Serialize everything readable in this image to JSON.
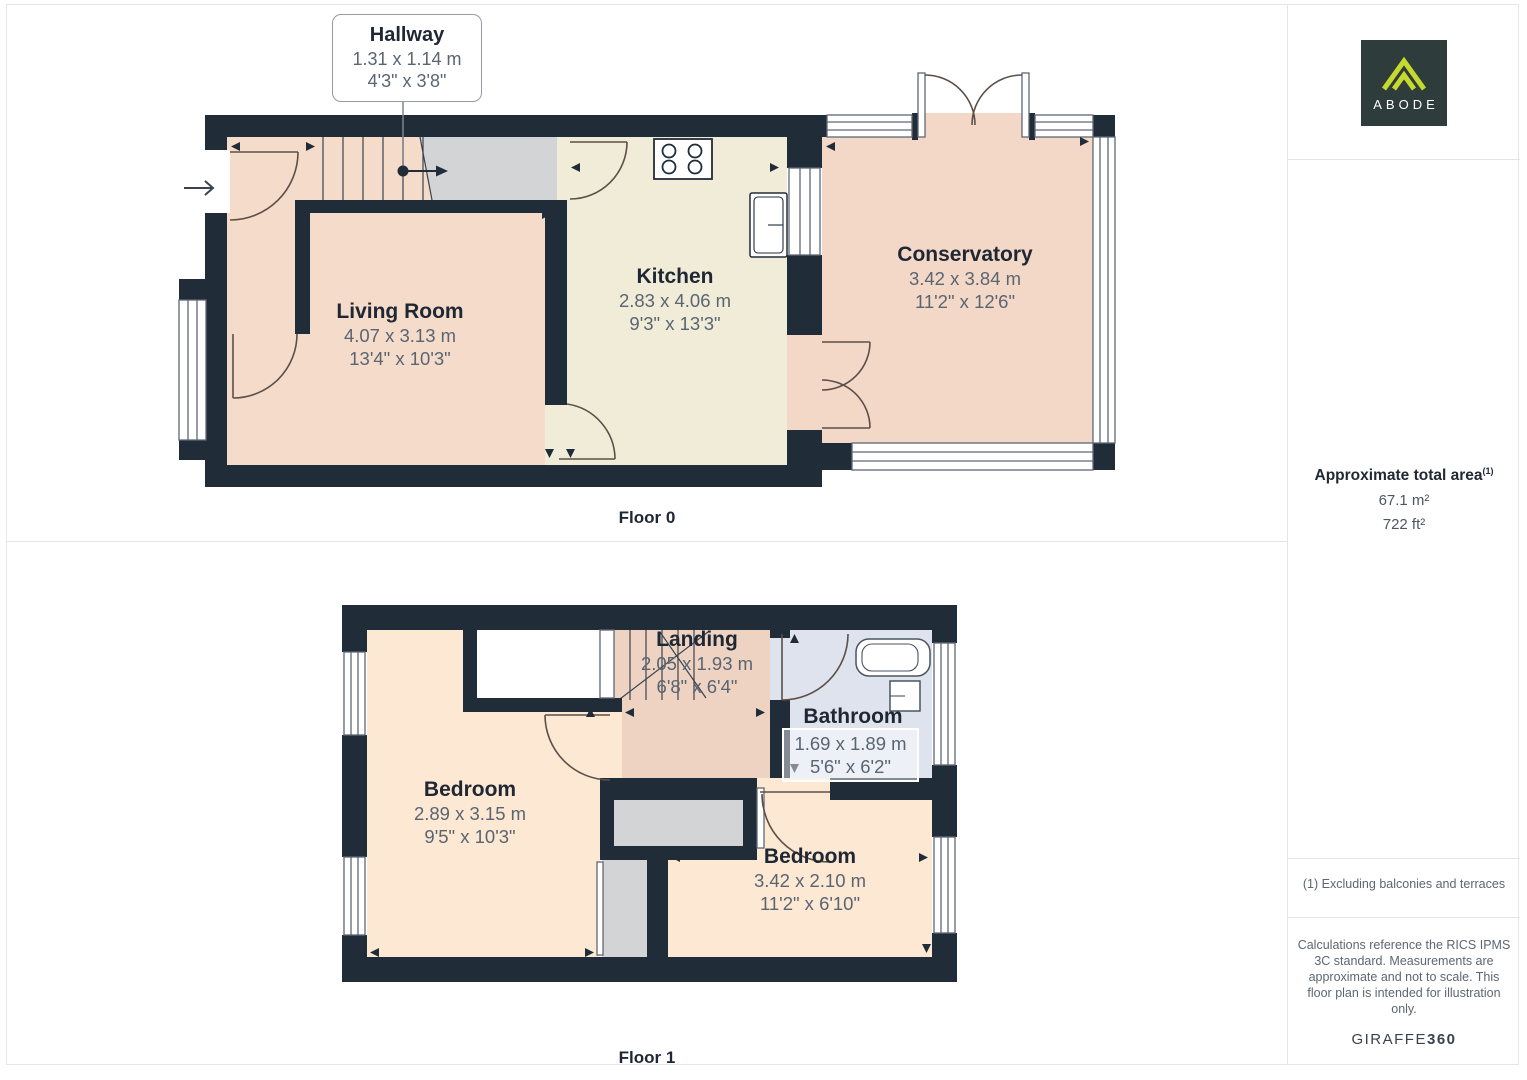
{
  "floors": [
    {
      "label": "Floor 0",
      "rooms": {
        "hallway": {
          "name": "Hallway",
          "metric": "1.31 x 1.14 m",
          "imperial": "4'3\" x 3'8\""
        },
        "living_room": {
          "name": "Living Room",
          "metric": "4.07 x 3.13 m",
          "imperial": "13'4\" x 10'3\""
        },
        "kitchen": {
          "name": "Kitchen",
          "metric": "2.83 x 4.06 m",
          "imperial": "9'3\" x 13'3\""
        },
        "conservatory": {
          "name": "Conservatory",
          "metric": "3.42 x 3.84 m",
          "imperial": "11'2\" x 12'6\""
        }
      }
    },
    {
      "label": "Floor 1",
      "rooms": {
        "landing": {
          "name": "Landing",
          "metric": "2.05 x 1.93 m",
          "imperial": "6'8\" x 6'4\""
        },
        "bathroom": {
          "name": "Bathroom",
          "metric": "1.69 x 1.89 m",
          "imperial": "5'6\" x 6'2\""
        },
        "bedroom_left": {
          "name": "Bedroom",
          "metric": "2.89 x 3.15 m",
          "imperial": "9'5\" x 10'3\""
        },
        "bedroom_right": {
          "name": "Bedroom",
          "metric": "3.42 x 2.10 m",
          "imperial": "11'2\" x 6'10\""
        }
      }
    }
  ],
  "sidebar": {
    "logo": {
      "text": "ABODE",
      "bg_color": "#2e3c3b",
      "accent_color": "#c6d92f"
    },
    "total_area": {
      "label": "Approximate total area",
      "footnote_marker": "(1)",
      "metric": "67.1 m²",
      "imperial": "722 ft²"
    },
    "footnote": "(1) Excluding balconies and terraces",
    "disclaimer": "Calculations reference the RICS IPMS 3C standard. Measurements are approximate and not to scale. This floor plan is intended for illustration only.",
    "credit_brand": "GIRAFFE",
    "credit_suffix": "360"
  },
  "colors": {
    "wall": "#212c39",
    "room_pink": "#f4dbca",
    "conservatory_pink": "#f3d8c8",
    "room_peach": "#fce8d3",
    "landing_pink": "#eed3c2",
    "kitchen_cream": "#f1ecd8",
    "bathroom_blue": "#dee3ee",
    "stairs_gray": "#d2d4d6",
    "divider": "#e4e6e9",
    "dim_text": "#5a6572",
    "name_text": "#1e2733"
  }
}
